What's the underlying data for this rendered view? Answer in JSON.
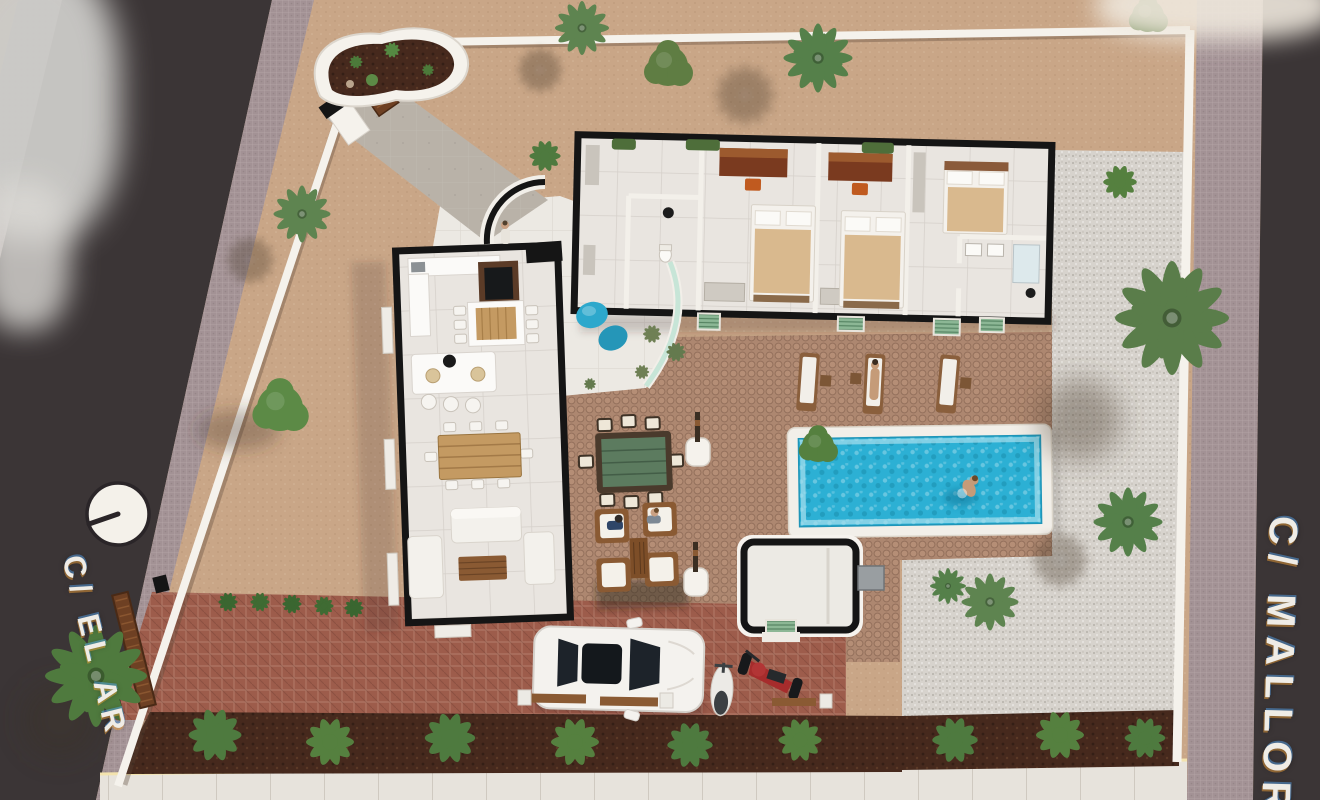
{
  "scene": {
    "type": "architectural-3d-site-plan",
    "description": "Top-down 3D render of a single-storey villa floor plan with swimming pool, cobbled patio, brick driveway, gravel gardens, palm trees and two bordering streets"
  },
  "streets": {
    "left_label": "C/ EL AR",
    "right_label": "C/ MALLOR"
  },
  "icons": {
    "street_marker": "streetlight-top-view"
  },
  "colors": {
    "sand": "#c9a687",
    "road": "#3b3536",
    "sidewalk": "#a39295",
    "wall_white": "#f5f2ec",
    "patio_cobble": "#ad8770",
    "brick_drive": "#9d5c4b",
    "gravel": "#d7d3cd",
    "soil": "#46291d",
    "foliage": "#4e7a3f",
    "palm": "#55804a",
    "pool_water": "#2cb0d4",
    "pool_deck": "#f2efe9",
    "floor_tile": "#e9e5e0",
    "cut_wall": "#151515",
    "wood": "#c49a62",
    "wood_dark": "#6b4a2a",
    "beanbag_blue": "#2da8cc",
    "outdoor_table": "#5c7b5f",
    "car_white": "#f4f2ee",
    "moto_red": "#a62c2c",
    "mat_green": "#8cb795",
    "lit_edge": "#f3e3ae",
    "walkway": "#b9b2a8",
    "street_text": "#efece6"
  }
}
